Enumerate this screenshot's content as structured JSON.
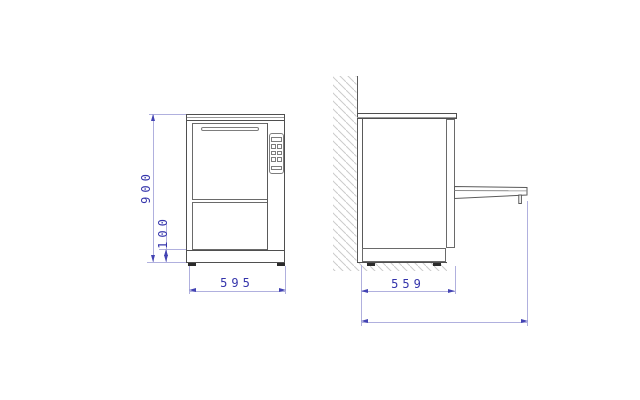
{
  "document": {
    "type": "technical-drawing",
    "subject": "under-counter appliance with fold-down door, dimensioned front and side installation views",
    "background_color": "#ffffff"
  },
  "views": {
    "front": {
      "label": "front-view",
      "dimensions": {
        "height": "900",
        "plinth_height": "100",
        "width": "595"
      },
      "features": [
        "worktop",
        "door",
        "door-handle-slot",
        "control-panel",
        "lower-panel",
        "plinth",
        "feet"
      ]
    },
    "side": {
      "label": "side-view",
      "dimensions": {
        "depth": "559",
        "depth_door_open": "1000"
      },
      "features": [
        "wall-section-hatch",
        "worktop",
        "door-profile",
        "open-door-flap",
        "plinth",
        "feet",
        "floor-section-hatch"
      ]
    }
  },
  "style": {
    "drawing_line_color": "#4f4f4f",
    "dimension_line_color": "#b0b0de",
    "dimension_text_color": "#3434ab",
    "arrow_color": "#4343b3",
    "hatch_color": "#cbcbcb"
  }
}
